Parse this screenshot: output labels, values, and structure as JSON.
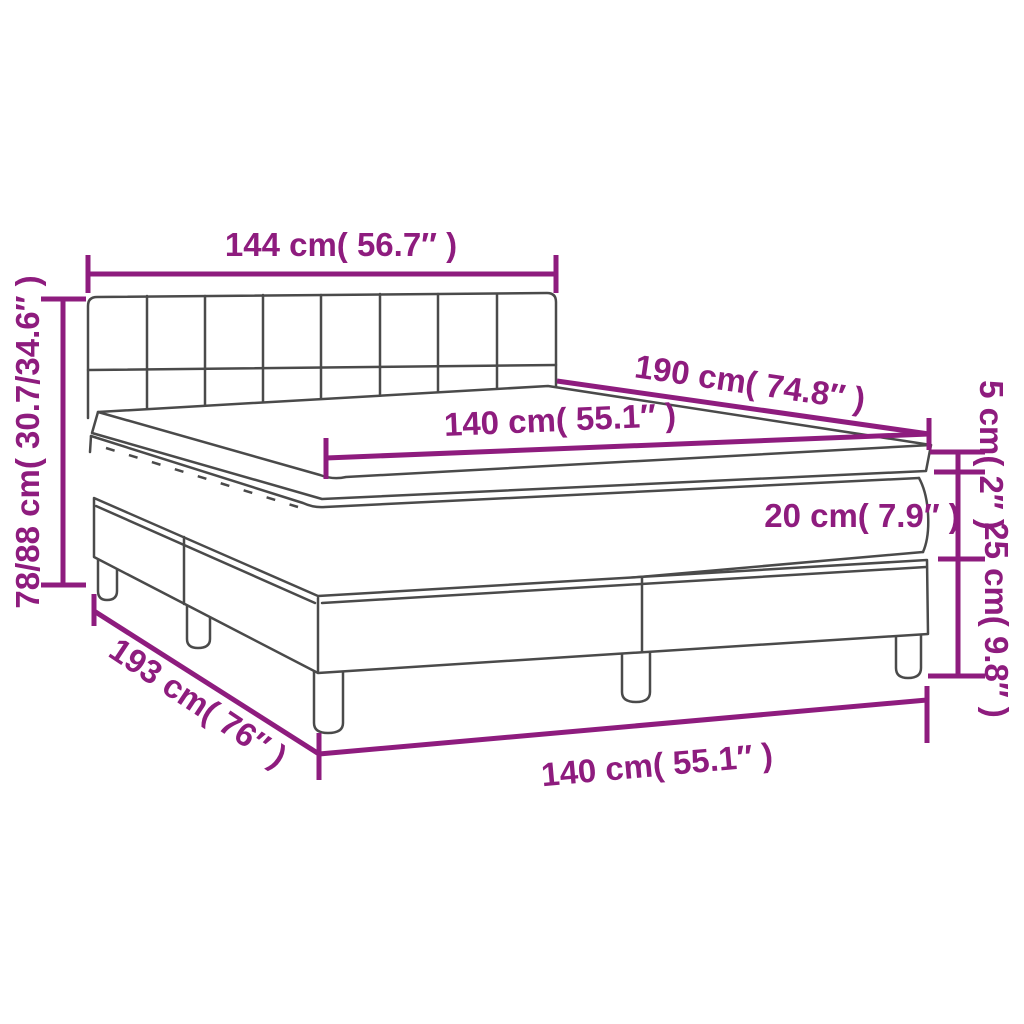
{
  "diagram": {
    "title": "Box spring bed dimension diagram",
    "colors": {
      "dimension_magenta": "#8e1c7e",
      "drawing_gray": "#4a4a4a",
      "background": "#ffffff"
    },
    "labels": {
      "headboard_width": "144 cm( 56.7″ )",
      "total_height": "78/88 cm( 30.7/34.6″ )",
      "bed_length": "190 cm( 74.8″ )",
      "mattress_width": "140 cm( 55.1″ )",
      "topper_thickness": "5 cm( 2″ )",
      "mattress_thickness": "20 cm( 7.9″ )",
      "base_height": "25 cm( 9.8″ )",
      "total_length": "193 cm( 76″ )",
      "mattress_width_bottom": "140 cm( 55.1″ )"
    }
  }
}
